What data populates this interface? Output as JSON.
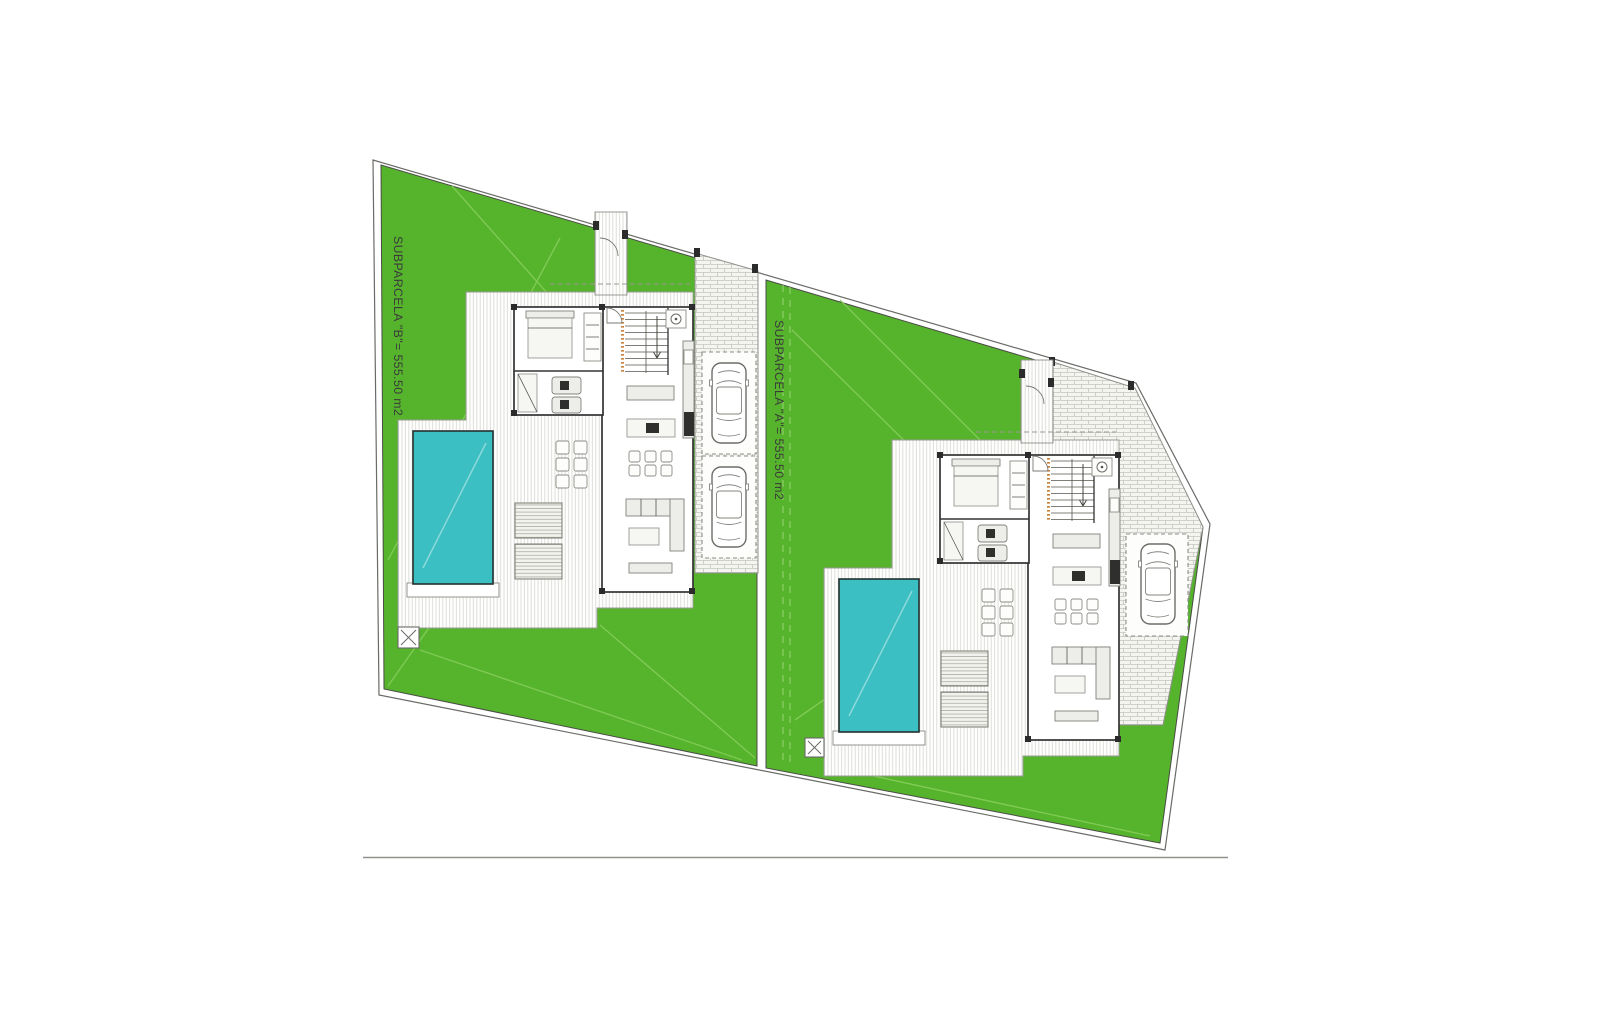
{
  "drawing": {
    "type": "architectural site plan, ground floor of two semi-detached villas",
    "parcels": [
      {
        "id": "B",
        "label": "SUBPARCELA \"B\"= 555.50 m2",
        "area_m2": "555.50"
      },
      {
        "id": "A",
        "label": "SUBPARCELA \"A\"= 555.50 m2",
        "area_m2": "555.50"
      }
    ]
  },
  "colors": {
    "lawn_green": "#56b32c",
    "lawn_line": "#86cf5c",
    "pool_teal": "#3bbfc3",
    "paving_fill": "#f4f4f0",
    "paving_line": "#c6c6bf",
    "hatch_line": "#d9d9d3",
    "wall_dark": "#333333",
    "stair_accent": "#c9803a",
    "boundary_line": "#6a6a66",
    "label_text": "#3a3a3a"
  },
  "icons": {
    "car": "car-top-view-icon",
    "pool": "swimming-pool-icon",
    "sun_lounger": "sun-lounger-icon",
    "utility_marker": "x-box-marker-icon"
  }
}
